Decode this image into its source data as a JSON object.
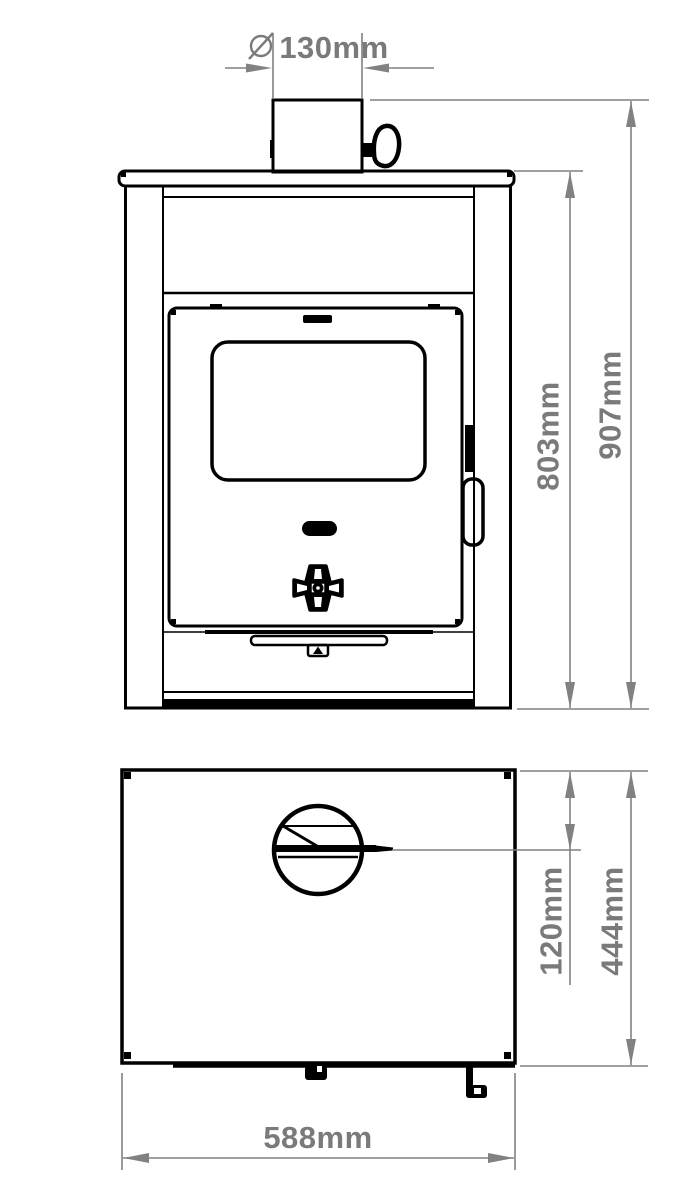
{
  "drawing": {
    "type": "technical-drawing",
    "subject": "Wood-burning stove - front and top orthographic views with dimensions",
    "colors": {
      "outline": "#000000",
      "dimension_line": "#818181",
      "dimension_text": "#7a7a7a",
      "background": "#ffffff"
    },
    "front_view": {
      "name": "front view",
      "dimensions": {
        "flue_diameter": {
          "symbol": "⌀",
          "value": "130mm"
        },
        "body_height": {
          "value": "803mm"
        },
        "total_height": {
          "value": "907mm"
        }
      }
    },
    "top_view": {
      "name": "top view",
      "dimensions": {
        "flue_handle_offset": {
          "value": "120mm"
        },
        "depth": {
          "value": "444mm"
        },
        "width": {
          "value": "588mm"
        }
      }
    }
  }
}
